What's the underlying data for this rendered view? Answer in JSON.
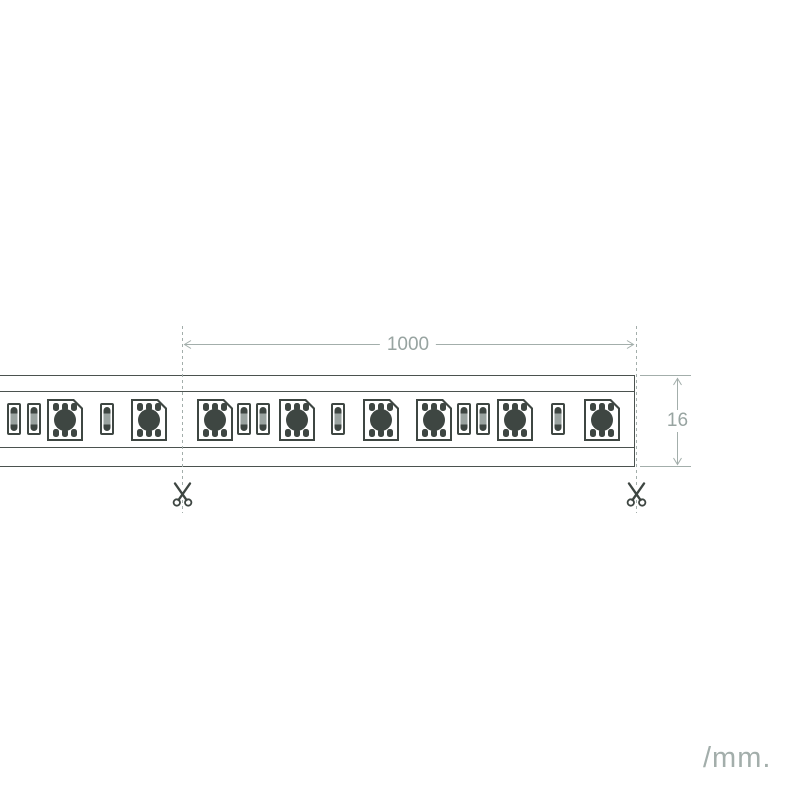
{
  "colors": {
    "ink": "#3e4642",
    "line": "#4b524f",
    "dim": "#a3aeab",
    "dim_text": "#98a4a1",
    "background": "#ffffff"
  },
  "annotations": {
    "length_value": "1000",
    "height_value": "16",
    "unit_label": "/mm.",
    "cut_icon": "scissors-icon"
  },
  "strip": {
    "cut_lines_x": [
      182.5,
      636.5
    ],
    "components": [
      {
        "t": "res",
        "x": 7
      },
      {
        "t": "res",
        "x": 27
      },
      {
        "t": "led",
        "x": 47
      },
      {
        "t": "res",
        "x": 100
      },
      {
        "t": "led",
        "x": 131
      },
      {
        "t": "led",
        "x": 197
      },
      {
        "t": "res",
        "x": 237
      },
      {
        "t": "res",
        "x": 256
      },
      {
        "t": "led",
        "x": 279
      },
      {
        "t": "res",
        "x": 331
      },
      {
        "t": "led",
        "x": 363
      },
      {
        "t": "led",
        "x": 416
      },
      {
        "t": "res",
        "x": 457
      },
      {
        "t": "res",
        "x": 476
      },
      {
        "t": "led",
        "x": 497
      },
      {
        "t": "res",
        "x": 551
      },
      {
        "t": "led",
        "x": 584
      }
    ]
  }
}
